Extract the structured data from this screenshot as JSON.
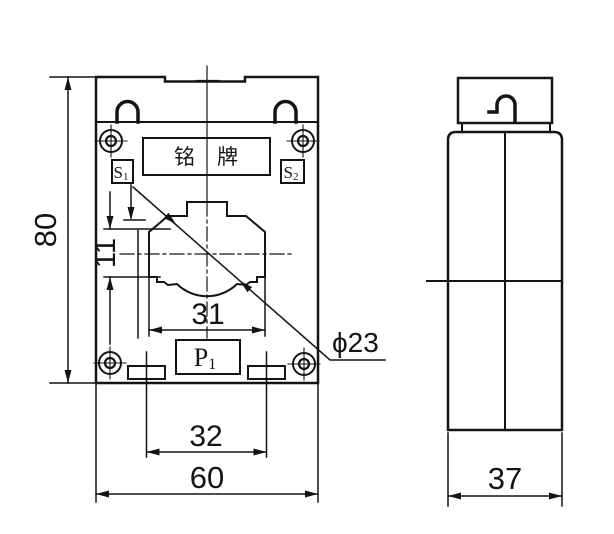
{
  "canvas": {
    "background": "#ffffff",
    "line_color": "#141414"
  },
  "front_view": {
    "nameplate_text": "铭牌",
    "terminals": {
      "s1": {
        "base": "S",
        "sub": "1"
      },
      "s2": {
        "base": "S",
        "sub": "2"
      },
      "p1": {
        "base": "P",
        "sub": "1"
      }
    },
    "dimensions": {
      "overall_height": "80",
      "overall_width": "60",
      "slot_spacing": "32",
      "window_width": "31",
      "window_side_height": "11",
      "aperture_diameter": "ϕ23"
    }
  },
  "side_view": {
    "dimensions": {
      "depth": "37"
    }
  }
}
